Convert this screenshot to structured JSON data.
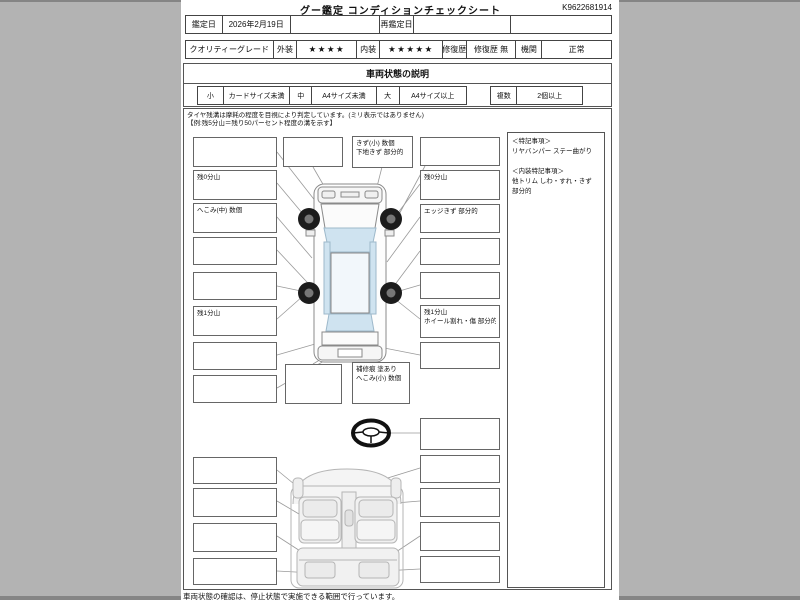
{
  "page": {
    "title": "グー鑑定 コンディションチェックシート",
    "ref_number": "K9622681914",
    "footer_note": "車両状態の確認は、停止状態で実施できる範囲で行っています。"
  },
  "header_table": {
    "appraisal_date_label": "鑑定日",
    "appraisal_date": "2026年2月19日",
    "re_appraisal_label": "再鑑定日",
    "re_appraisal_date": ""
  },
  "grade_table": {
    "quality_label": "クオリティーグレード",
    "exterior_label": "外装",
    "exterior_stars": "★★★★",
    "interior_label": "内装",
    "interior_stars": "★★★★★",
    "repair_label": "修復歴",
    "repair_value": "修復歴 無",
    "engine_label": "機関",
    "engine_value": "正常"
  },
  "explanation": {
    "title": "車両状態の説明",
    "legend": [
      {
        "size": "小",
        "desc": "カードサイズ未満"
      },
      {
        "size": "中",
        "desc": "A4サイズ未満"
      },
      {
        "size": "大",
        "desc": "A4サイズ以上"
      }
    ],
    "multi": {
      "size": "複数",
      "desc": "2個以上"
    },
    "tire_note1": "タイヤ残溝は摩耗の程度を目視により判定しています。(ミリ表示ではありません)",
    "tire_note2": "【例:残5分山＝残り50パーセント程度の溝を示す】"
  },
  "callouts": {
    "left": [
      [
        "",
        ""
      ],
      [
        "残0分山",
        ""
      ],
      [
        "へこみ(中) 数個",
        ""
      ],
      [
        "",
        ""
      ],
      [
        "",
        ""
      ],
      [
        "残1分山",
        ""
      ],
      [
        "",
        ""
      ],
      [
        "",
        ""
      ]
    ],
    "top_mid": [
      [
        "",
        ""
      ],
      [
        "きず(小) 数個",
        "下地きず 部分的"
      ]
    ],
    "right": [
      [
        "",
        ""
      ],
      [
        "残0分山",
        ""
      ],
      [
        "エッジきず 部分的",
        ""
      ],
      [
        "",
        ""
      ],
      [
        "",
        ""
      ],
      [
        "残1分山",
        "ホイール割れ・傷 部分的"
      ],
      [
        "",
        ""
      ]
    ],
    "bottom_mid": [
      [
        "",
        ""
      ],
      [
        "補修痕 塗あり",
        "へこみ(小) 数個"
      ]
    ],
    "steering": [
      [
        "",
        ""
      ]
    ],
    "interior_left": [
      [
        "",
        ""
      ],
      [
        "",
        ""
      ],
      [
        "",
        ""
      ],
      [
        "",
        ""
      ]
    ],
    "interior_right": [
      [
        "",
        ""
      ],
      [
        "",
        ""
      ],
      [
        "",
        ""
      ],
      [
        "",
        ""
      ]
    ]
  },
  "notes_panel": {
    "heading1": "＜特記事項＞",
    "item1": "リヤバンパー ステー曲がり",
    "heading2": "＜内装特記事項＞",
    "item2": "他トリム しわ・すれ・きず 部分的"
  }
}
